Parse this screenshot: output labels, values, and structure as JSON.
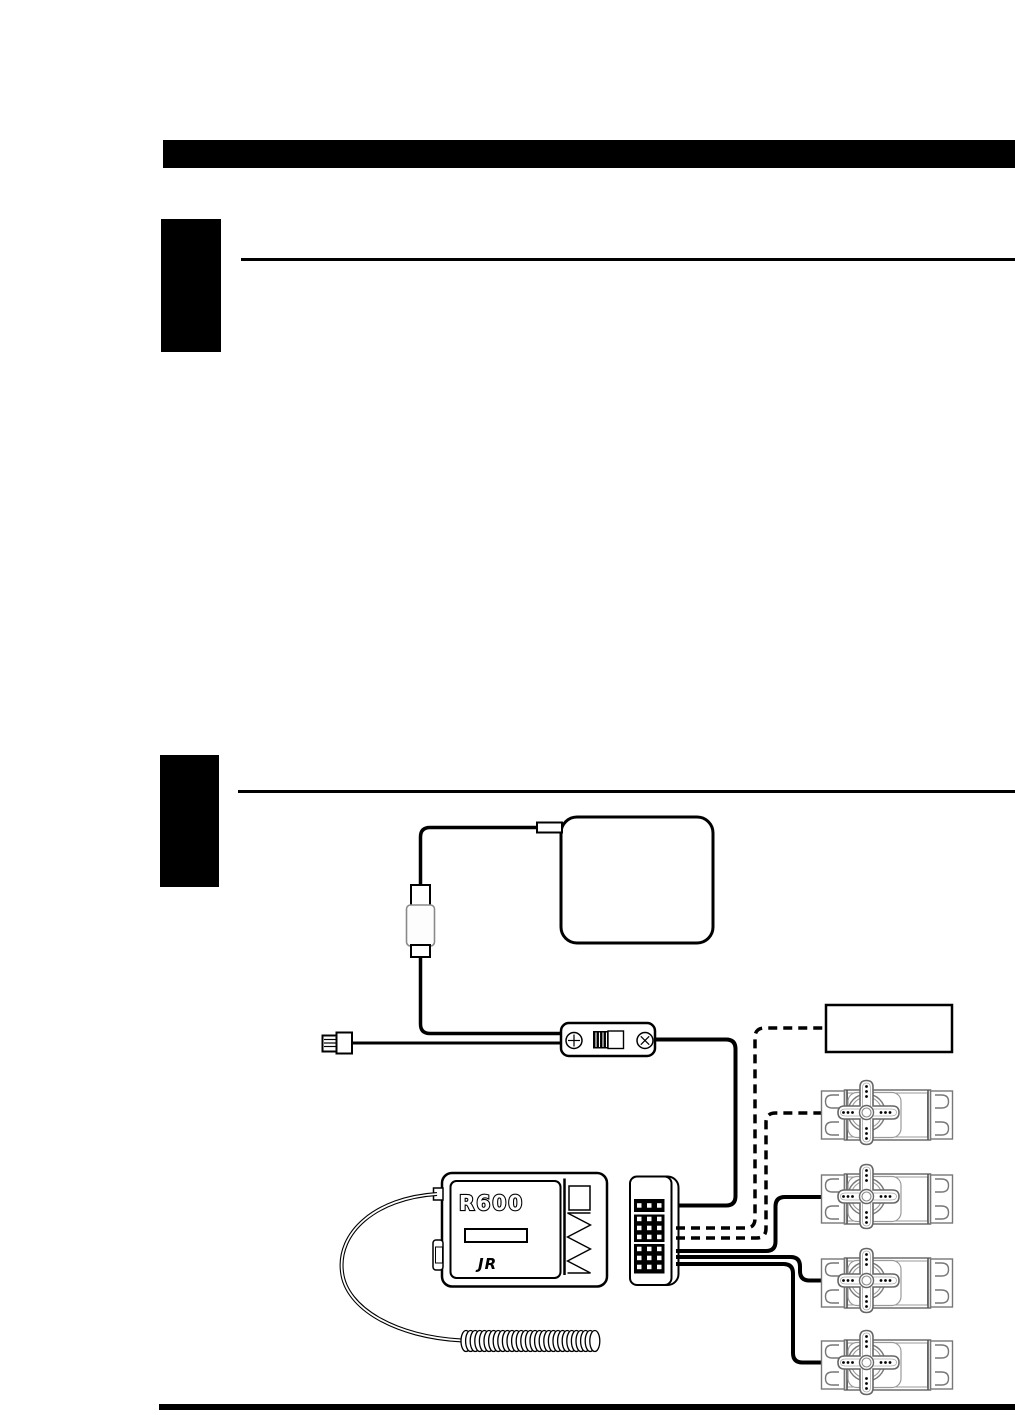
{
  "page": {
    "type": "manual-page",
    "background": "#ffffff",
    "ink": "#000000"
  },
  "header": {
    "bar_color": "#000000"
  },
  "sections": [
    {
      "tab_color": "#000000"
    },
    {
      "tab_color": "#000000"
    }
  ],
  "diagram": {
    "receiver": {
      "model": "R600",
      "brand": "JR"
    },
    "components": {
      "battery_pack": "battery-pack",
      "charge_plug": "flat-charge-plug",
      "inline_connector": "inline-connector",
      "switch_harness": "switch-harness",
      "connector_block": "receiver-connector-block",
      "aux_box": "aux-box",
      "servo_count": 4
    },
    "colors": {
      "wire": "#000000",
      "detail_gray": "#8a8a8a",
      "fill": "#ffffff"
    }
  }
}
